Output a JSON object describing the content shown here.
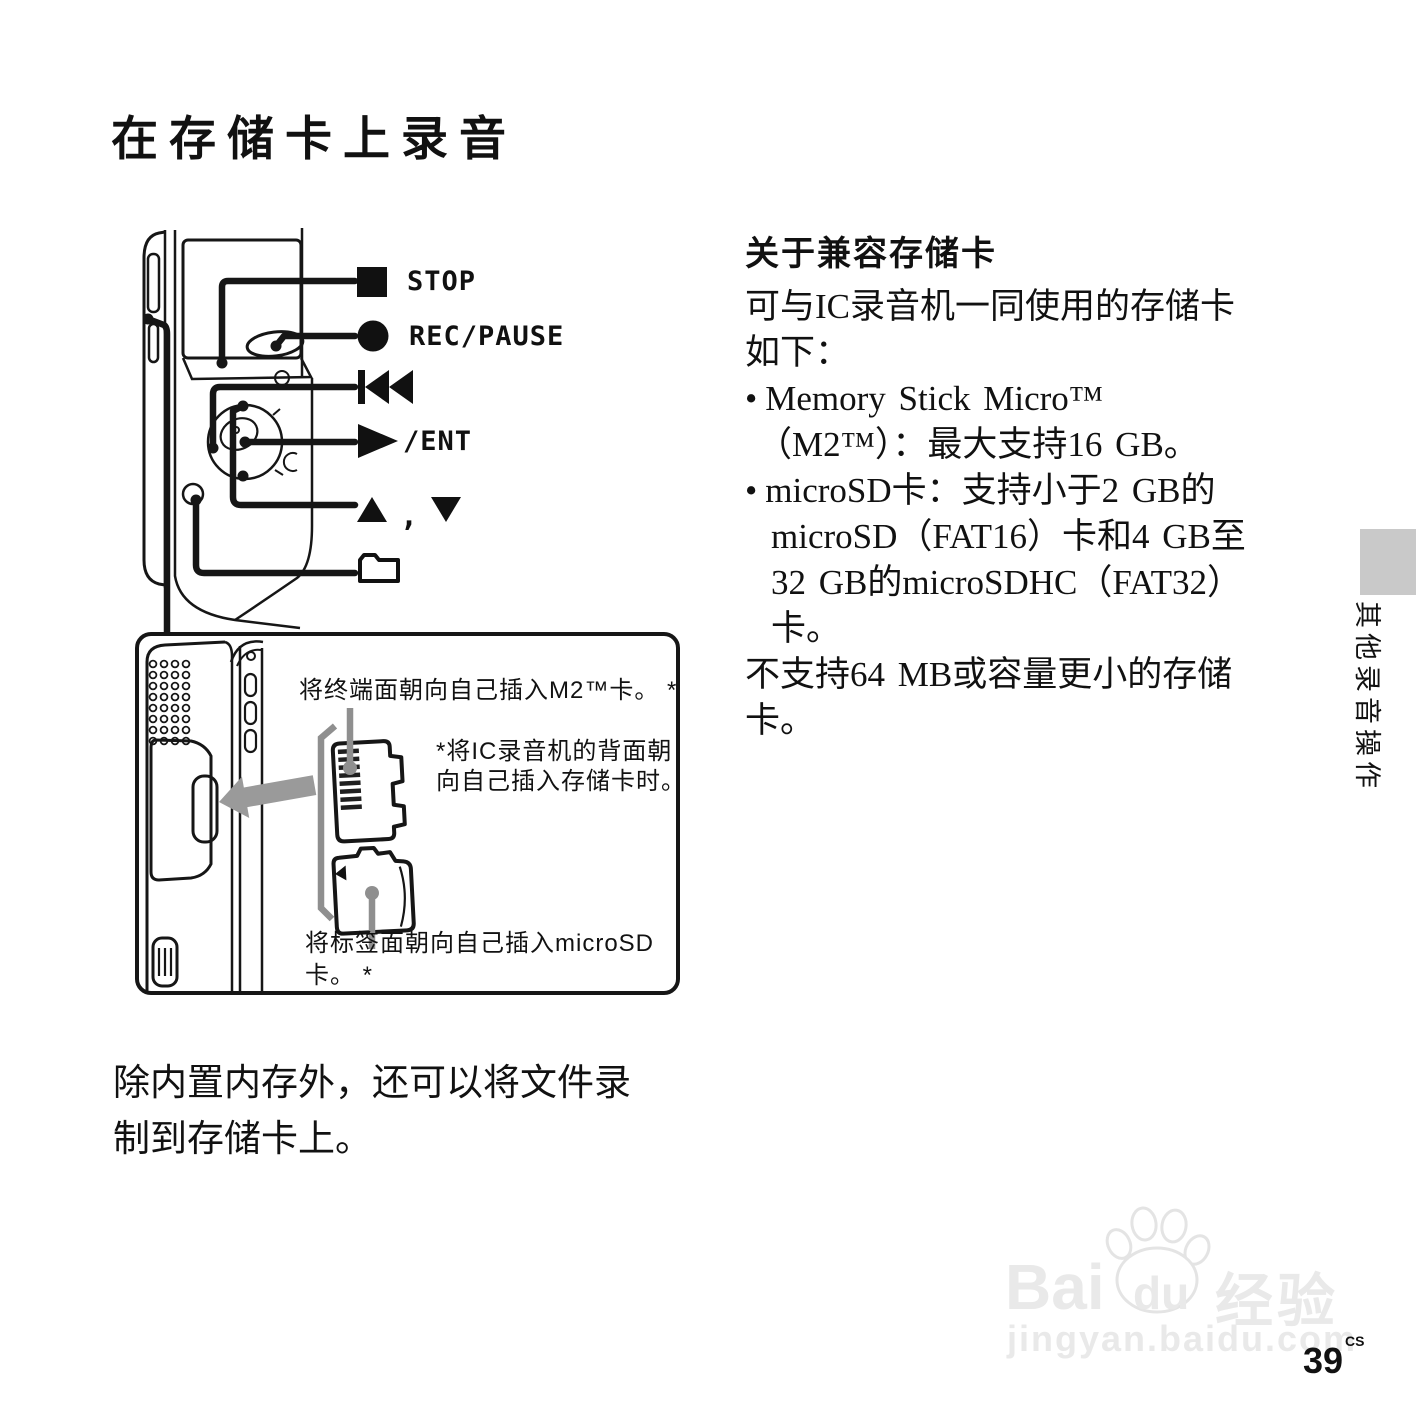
{
  "page": {
    "title": "在存储卡上录音",
    "number": "39",
    "number_suffix": "CS"
  },
  "colors": {
    "tab_gray": "#c9c9c9",
    "arrow_gray": "#9a9a9a",
    "callout_gray": "#8f8f8f",
    "watermark_gray": "#e9e9e9",
    "line_black": "#161616"
  },
  "icons": {
    "stop-square-icon": "■",
    "record-circle-icon": "●",
    "previous-track-icon": "⏮",
    "play-icon": "▶",
    "up-triangle-icon": "▲",
    "down-triangle-icon": "▼",
    "folder-icon": "🗀",
    "baidu-paw-icon": "paw",
    "insert-arrow-icon": "⬅"
  },
  "callouts": {
    "stop": "STOP",
    "rec_pause": "REC/PAUSE",
    "play_ent": "/ENT",
    "updown_comma": ","
  },
  "card_diagram": {
    "m2_instruction": "将终端面朝向自己插入M2™卡。 *",
    "back_note_line1": "*将IC录音机的背面朝",
    "back_note_line2": "向自己插入存储卡时。",
    "microsd_line1": "将标签面朝向自己插入microSD",
    "microsd_line2": "卡。 *"
  },
  "compat": {
    "heading": "关于兼容存储卡",
    "bullet_char": "•",
    "intro": [
      "可与IC录音机一同使用的存储卡",
      "如下："
    ],
    "bullet1": [
      "Memory Stick Micro™",
      "（M2™）：最大支持16 GB。"
    ],
    "bullet2": [
      "microSD卡：支持小于2 GB的",
      "microSD（FAT16）卡和4 GB至",
      "32 GB的microSDHC（FAT32）",
      "卡。"
    ],
    "outro": [
      "不支持64 MB或容量更小的存储",
      "卡。"
    ]
  },
  "side_tab": {
    "label": "其他录音操作"
  },
  "bottom_note": {
    "line1": "除内置内存外，还可以将文件录",
    "line2": "制到存储卡上。"
  },
  "watermark": {
    "brand_prefix": "Bai",
    "brand_mid": "du",
    "brand_suffix": "经验",
    "url": "jingyan.baidu.com"
  }
}
